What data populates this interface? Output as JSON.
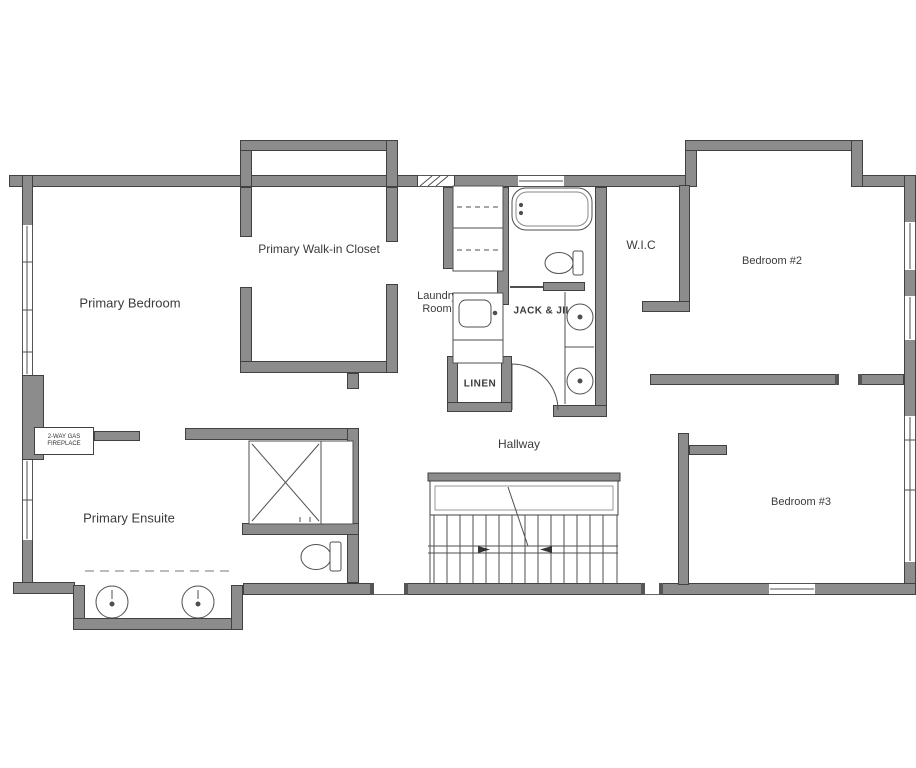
{
  "labels": {
    "primary_bedroom": "Primary Bedroom",
    "walkin_closet": "Primary Walk-in Closet",
    "laundry_line1": "Laundry",
    "laundry_line2": "Room",
    "jack_jill": "JACK & JILL",
    "wic": "W.I.C",
    "bedroom2": "Bedroom #2",
    "bedroom3": "Bedroom #3",
    "ensuite": "Primary Ensuite",
    "hallway": "Hallway",
    "linen": "LINEN",
    "shower": "SHOWER",
    "bench": "BENCH",
    "fireplace_line1": "2-WAY GAS",
    "fireplace_line2": "FIREPLACE",
    "washer": "W",
    "dryer": "D"
  },
  "colors": {
    "wall_fill": "#8c8c8c",
    "wall_outline": "#414141",
    "fixture_line": "#4f4f4f",
    "background": "#ffffff",
    "text": "#3b3b3b"
  }
}
